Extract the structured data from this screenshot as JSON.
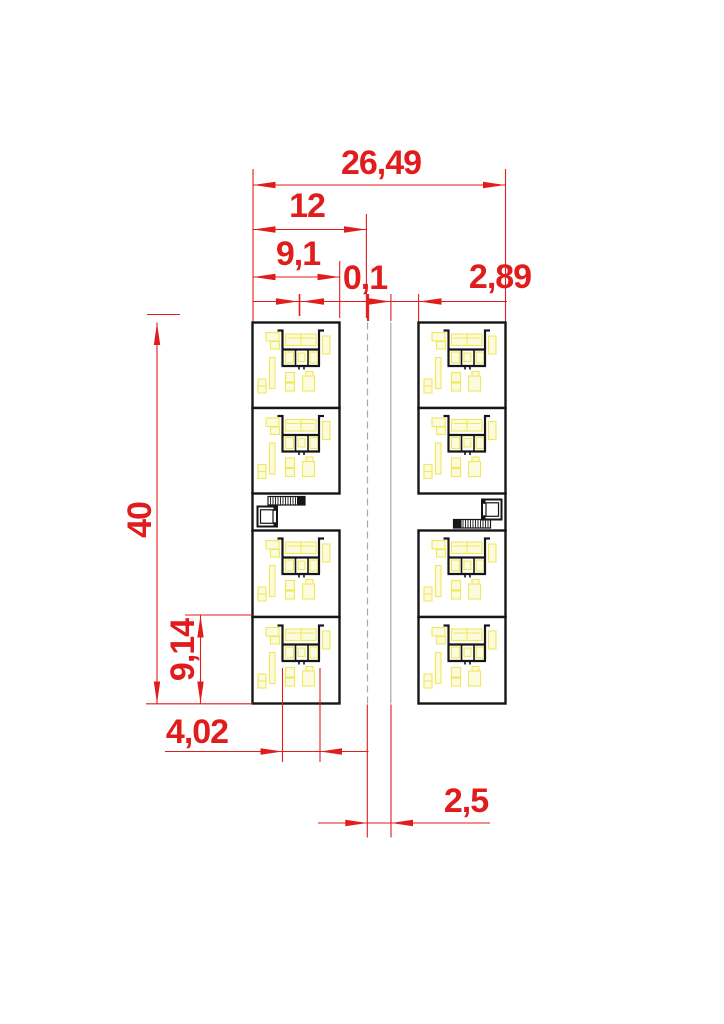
{
  "drawing": {
    "title": "Two-building residential floor plan with red CAD dimension lines",
    "buildings": 2,
    "rooms_per_building": 4,
    "rooms_total": 8,
    "elements": [
      "room",
      "bathroom-pod",
      "furniture",
      "stair",
      "elevator",
      "corridor"
    ]
  },
  "dimensions": {
    "top": [
      {
        "id": "total-width",
        "label": "26,49"
      },
      {
        "id": "building-width",
        "label": "12"
      },
      {
        "id": "room-depth",
        "label": "9,1"
      },
      {
        "id": "offset",
        "label": "0,1"
      },
      {
        "id": "corridor-width",
        "label": "2,89"
      }
    ],
    "left": [
      {
        "id": "total-height",
        "label": "40"
      },
      {
        "id": "room-height",
        "label": "9,14"
      }
    ],
    "bottom": [
      {
        "id": "pod-width",
        "label": "4,02"
      },
      {
        "id": "gap-width",
        "label": "2,5"
      }
    ]
  },
  "colors": {
    "dimension_red": "#e11c1c",
    "wall_black": "#161616",
    "boundary_gray": "#a8a8a8",
    "furniture_yellow": "#f0e95c",
    "background": "#ffffff"
  }
}
